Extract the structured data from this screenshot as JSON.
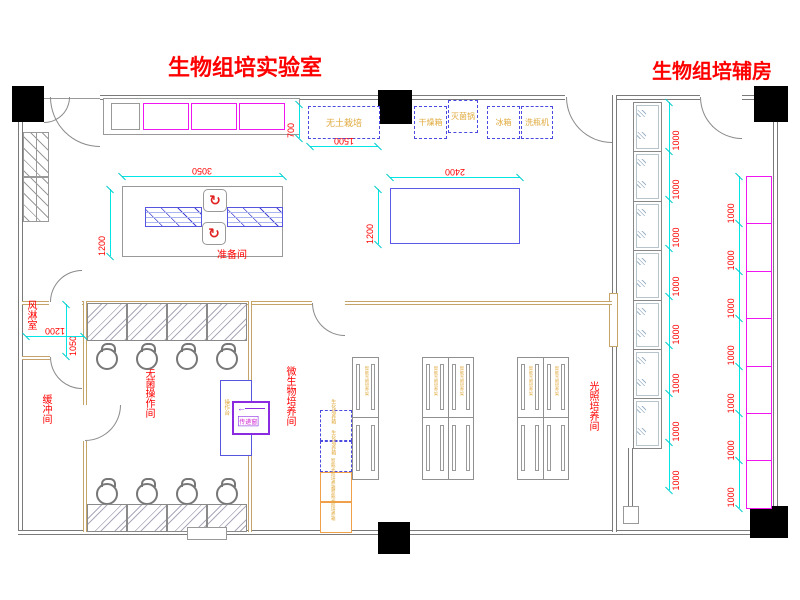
{
  "titles": {
    "main_room": "生物组培实验室",
    "aux_room": "生物组培辅房"
  },
  "room_labels": {
    "prep": "准备间",
    "air_shower": "风淋室",
    "buffer": "缓冲间",
    "sterile_op": "无菌操作间",
    "micro_culture": "微生物培养间",
    "light_culture": "光照培养间"
  },
  "equipment": {
    "top_row": [
      "无土栽培",
      "干燥箱",
      "灭菌锅",
      "冰箱",
      "洗瓶机"
    ],
    "pass_window": "传递窗",
    "transfer_bench": "操作台",
    "bio_incubators": [
      "生化培养箱",
      "生化培养箱"
    ],
    "light_incubators": [
      "智能光照培养箱",
      "智能光照培养箱"
    ],
    "rack_label": "智能光照培养架"
  },
  "dimensions": {
    "top_counter_depth": "700",
    "soilless_width": "1500",
    "prep_table_width": "3050",
    "prep_table_depth": "1200",
    "center_table_width": "2400",
    "center_table_depth": "1200",
    "air_shower_depth": "1050",
    "air_shower_width": "1200",
    "cabinet_units": [
      "1000",
      "1000",
      "1000",
      "1000",
      "1000",
      "1000",
      "1000",
      "1000"
    ],
    "counter_units": [
      "1000",
      "1000",
      "1000",
      "1000",
      "1000",
      "1000",
      "1000"
    ]
  },
  "counts": {
    "clean_benches_top": 4,
    "stools_top": 4,
    "clean_benches_bottom": 4,
    "stools_bottom": 4,
    "glass_cabinets": 7,
    "counter_cells": 7,
    "prep_benches": 2,
    "swivel_seats": 2,
    "top_counter_cells": 3,
    "culture_racks": 3
  },
  "colors": {
    "label_red": "#FF0000",
    "dim_cyan": "#00E5E5",
    "counter_magenta": "#F016F0",
    "equip_blue": "#4A4AE0",
    "equip_yellow": "#E0A93C",
    "incubator_orange": "#F0A048",
    "wall_tan": "#C4A468",
    "wall_gray": "#7A7A7A",
    "pass_violet": "#8A2BE2",
    "column_black": "#000000"
  }
}
